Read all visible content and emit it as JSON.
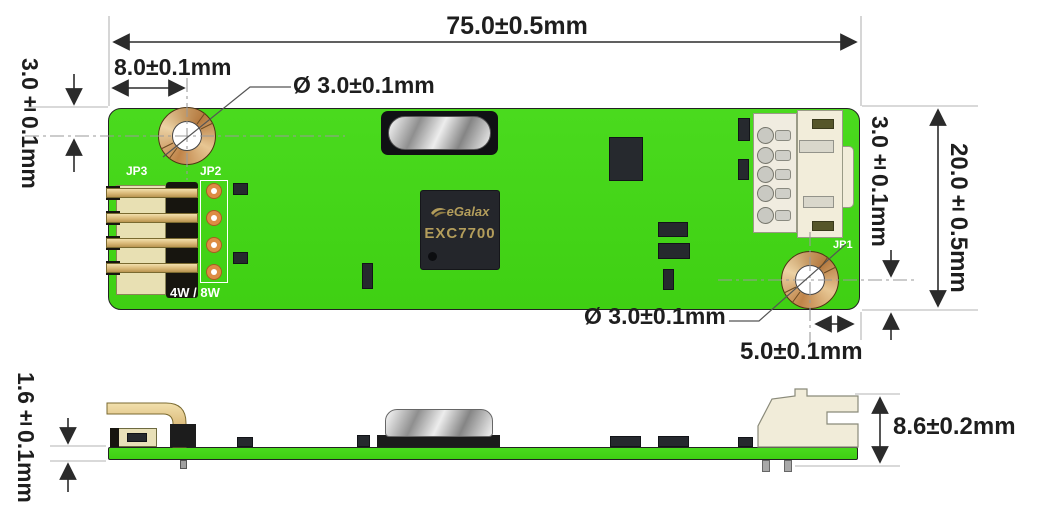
{
  "dims": {
    "overall_width": "75.0±0.5mm",
    "hole1_offset_x": "8.0±0.1mm",
    "hole1_offset_y": "3.0±0.1mm",
    "hole1_diameter": "Ø 3.0±0.1mm",
    "hole2_diameter": "Ø 3.0±0.1mm",
    "hole2_offset_y": "3.0±0.1mm",
    "overall_height": "20.0±0.5mm",
    "hole2_offset_x": "5.0±0.1mm",
    "board_thickness": "1.6±0.1mm",
    "connector_height": "8.6±0.2mm"
  },
  "labels": {
    "jp3": "JP3",
    "jp2": "JP2",
    "jp1": "JP1",
    "wire_mode": "4W / 8W",
    "usb": "USB 232",
    "chip_brand": "eGalax",
    "chip_model": "EXC7700"
  },
  "colors": {
    "pcb_green": "#48d51d",
    "copper_pad": "#c99055",
    "gold_pin": "#e3c389",
    "silkscreen": "#ffffff",
    "chip_text": "#b39d5b"
  }
}
